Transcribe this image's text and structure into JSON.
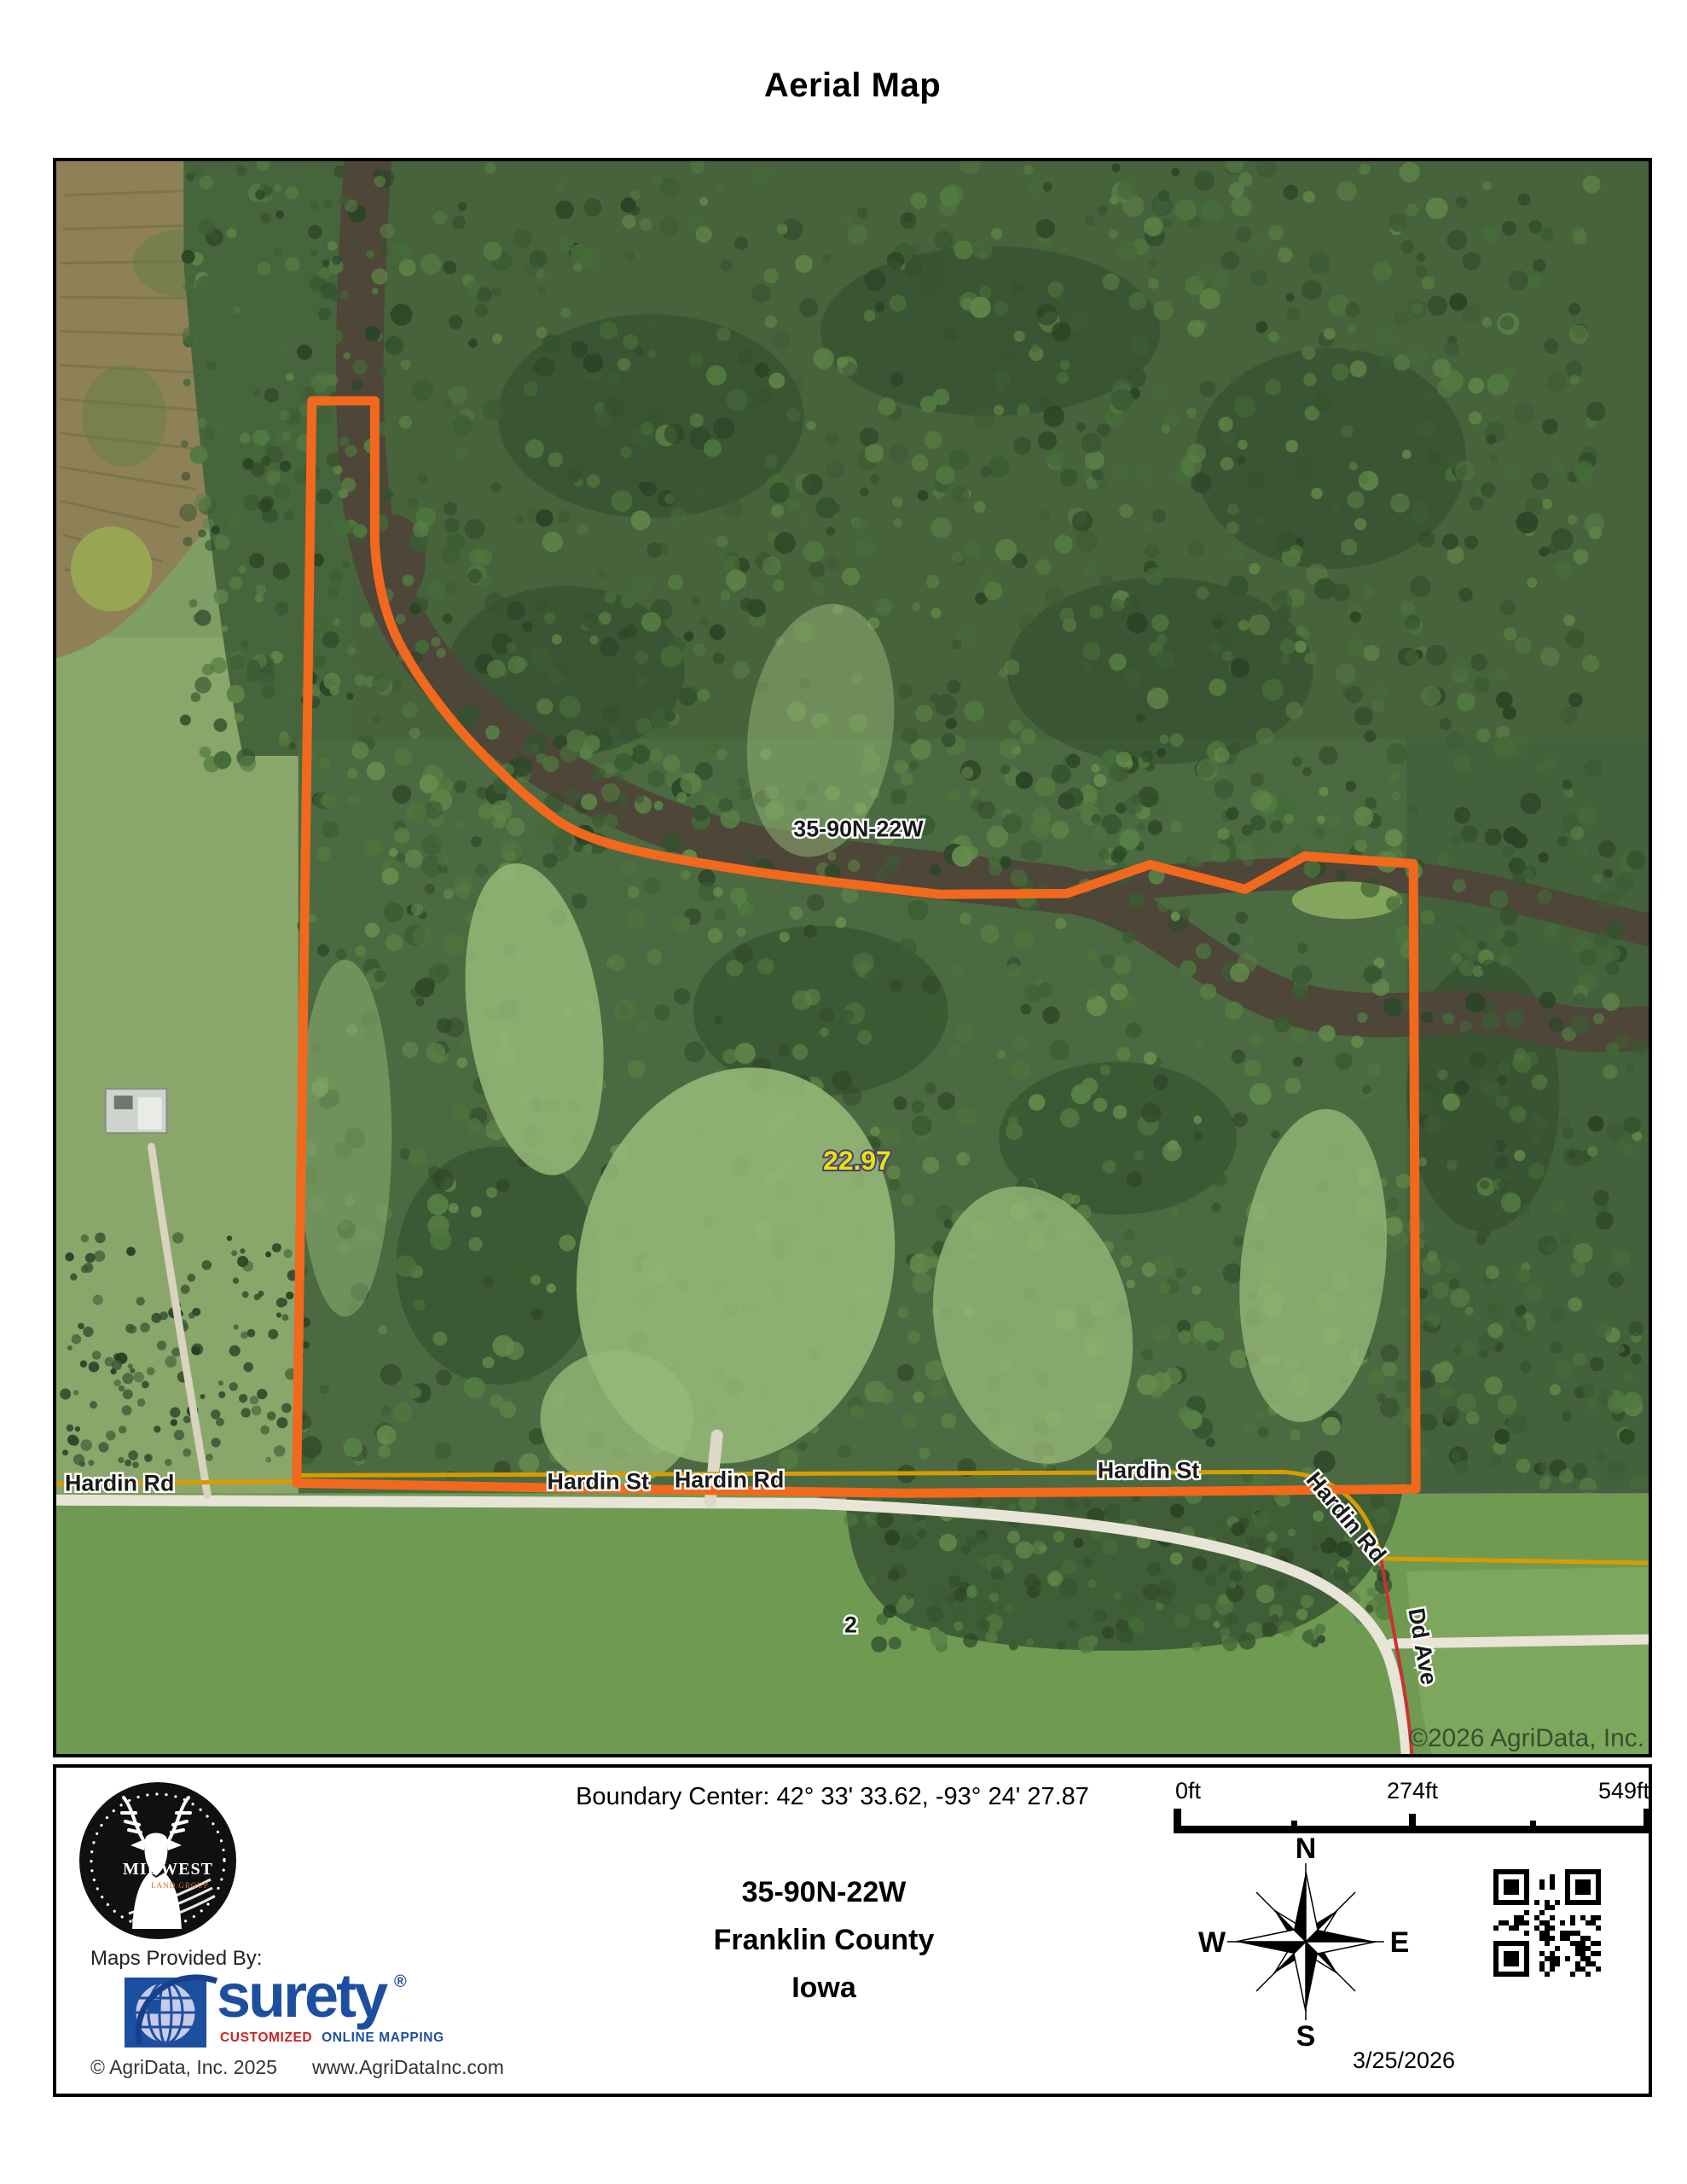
{
  "title": "Aerial Map",
  "map": {
    "section_label": "35-90N-22W",
    "acreage_label": "22.97",
    "lot_number": "2",
    "watermark": "©2026 AgriData, Inc.",
    "roads": {
      "west": "Hardin Rd",
      "mid_st": "Hardin St",
      "mid_rd": "Hardin Rd",
      "east_st": "Hardin St",
      "east_rd": "Hardin Rd",
      "ave": "Dd Ave"
    },
    "colors": {
      "parcel_boundary": "#f2681c",
      "acreage_text": "#ece400",
      "road_overlay_gold": "#d89c00",
      "road_overlay_red": "#c83232"
    }
  },
  "footer": {
    "boundary_center": "Boundary Center: 42° 33' 33.62,  -93° 24' 27.87",
    "section": "35-90N-22W",
    "county": "Franklin County",
    "state": "Iowa",
    "scale": {
      "t0": "0ft",
      "t1": "274ft",
      "t2": "549ft"
    },
    "compass": {
      "n": "N",
      "e": "E",
      "s": "S",
      "w": "W"
    },
    "date": "3/25/2026",
    "maps_provided_by": "Maps Provided By:",
    "surety": {
      "name": "surety",
      "reg": "®",
      "tag_red": "CUSTOMIZED",
      "tag_blue": "ONLINE MAPPING"
    },
    "agridata_copyright": "© AgriData, Inc. 2025",
    "website": "www.AgriDataInc.com",
    "mlg": {
      "name": "MIDWEST",
      "sub": "LAND GROUP"
    }
  }
}
